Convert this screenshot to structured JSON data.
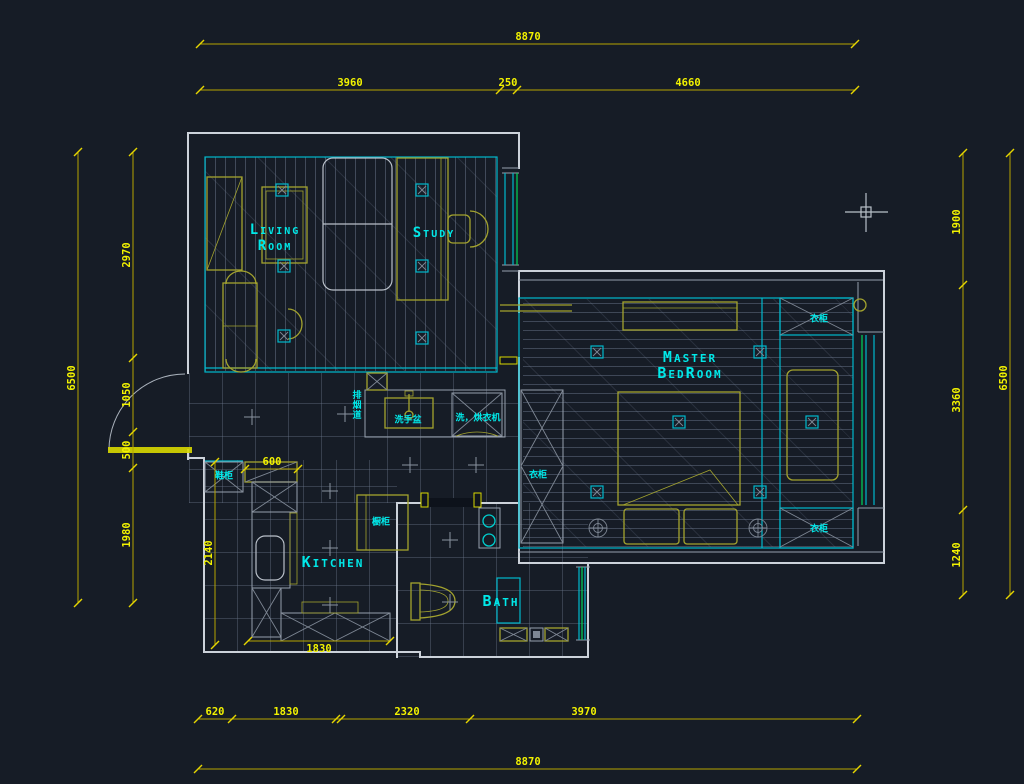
{
  "drawing": {
    "rooms": {
      "living_line1": "Living",
      "living_line2": "Room",
      "study": "Study",
      "master_line1": "Master",
      "master_line2": "BedRoom",
      "kitchen": "Kitchen",
      "bath": "Bath"
    },
    "annotations": {
      "shoe_cabinet": "鞋柜",
      "wash_basin": "洗手盆",
      "washer_dryer": "洗，烘衣机",
      "cupboard": "橱柜",
      "flue": "排烟道",
      "wardrobe_left": "衣柜",
      "wardrobe_top_right": "衣柜",
      "wardrobe_bottom_right": "衣柜"
    },
    "dimensions": {
      "top_overall": "8870",
      "top_segments": [
        "3960",
        "250",
        "4660"
      ],
      "bottom_segments": [
        "620",
        "1830",
        "2320",
        "3970"
      ],
      "bottom_overall": "8870",
      "left_overall": "6500",
      "left_segments": [
        "2970",
        "1050",
        "500",
        "1980"
      ],
      "kitchen_height": "2140",
      "right_segments": [
        "1900",
        "3360",
        "1240"
      ],
      "right_overall": "6500",
      "shoe_cabinet_width": "600",
      "kitchen_width": "1830"
    },
    "colors": {
      "background": "#161c26",
      "dimension_line": "#b5a400",
      "dimension_text": "#f2f200",
      "label_cyan": "#00e9e9",
      "wall": "#ccd2da",
      "furniture": "#a3a32e",
      "highlight_yellow": "#d9d900",
      "window_green": "#00d75a",
      "crosshair": "#b9c1c9"
    }
  }
}
